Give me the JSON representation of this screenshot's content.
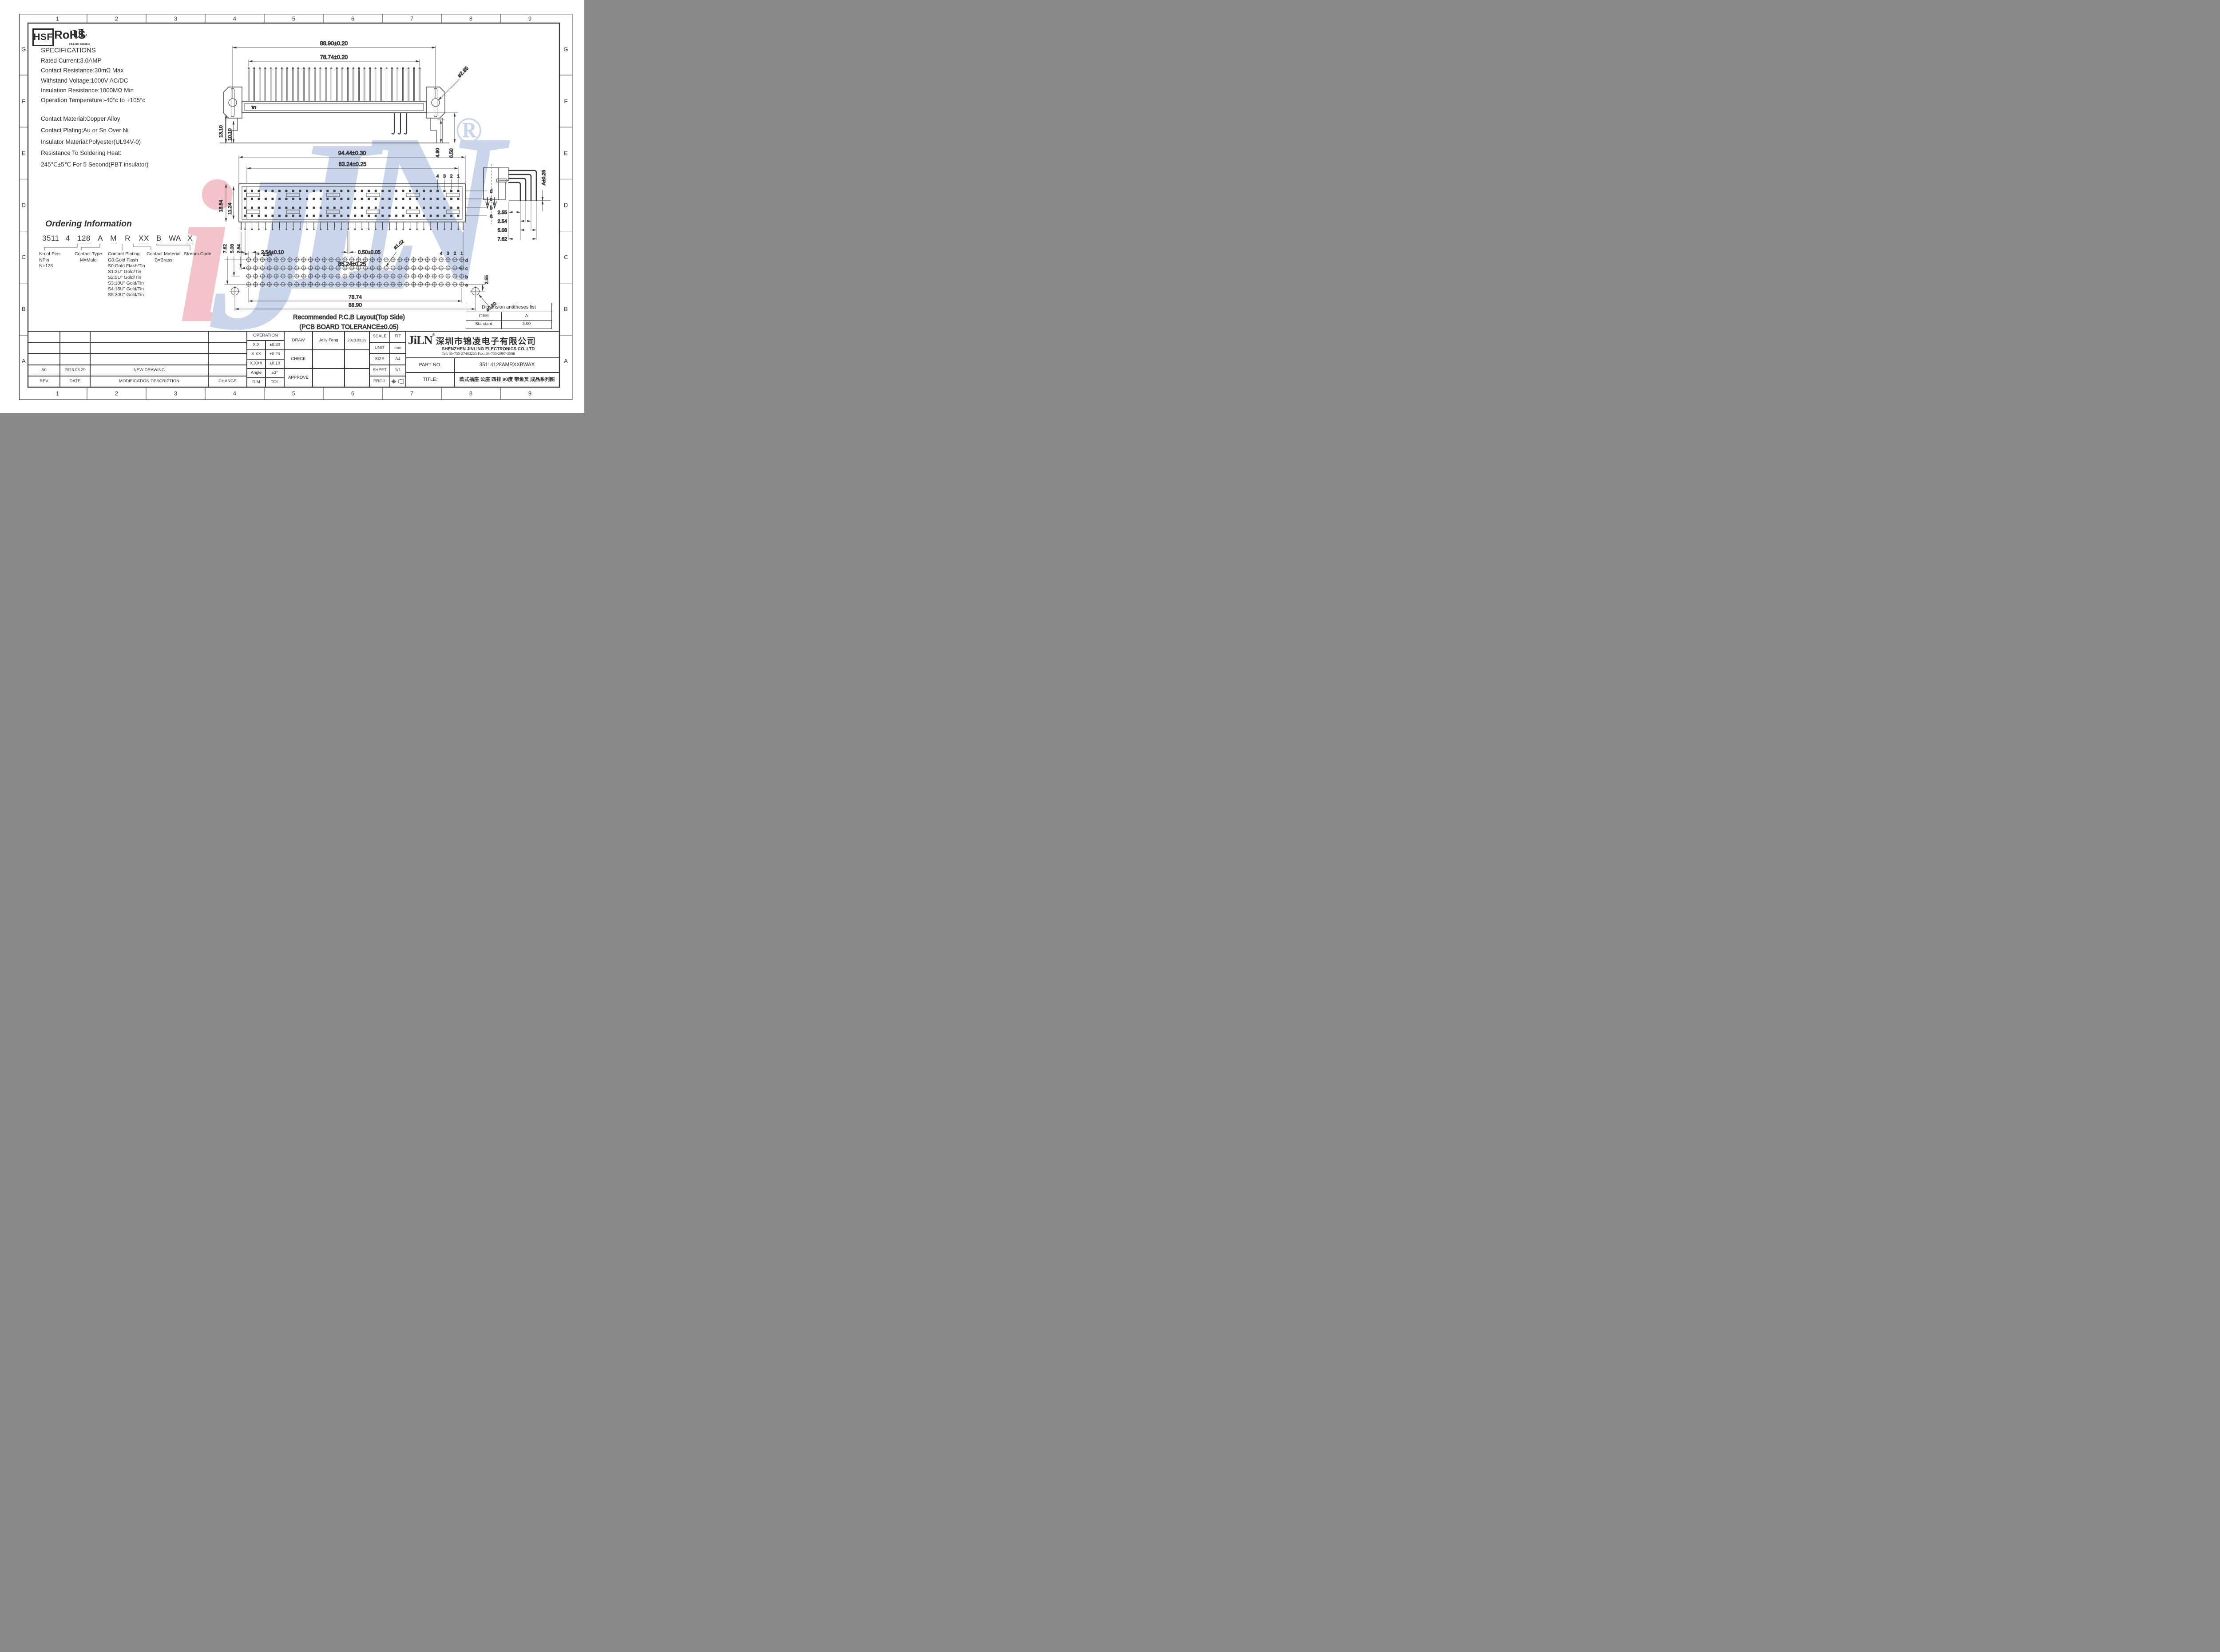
{
  "page": {
    "columns": [
      "1",
      "2",
      "3",
      "4",
      "5",
      "6",
      "7",
      "8",
      "9"
    ],
    "rows": [
      "G",
      "F",
      "E",
      "D",
      "C",
      "B",
      "A"
    ]
  },
  "certifications": {
    "hsf": "HSF",
    "rohs": "RoHS",
    "ul_mark": "UL",
    "ul_file": "FILE NO :E362810"
  },
  "specifications": {
    "title": "SPECIFICATIONS",
    "electrical": [
      "Rated Current:3.0AMP",
      "Contact Resistance:30mΩ Max",
      "Withstand Voltage:1000V AC/DC",
      "Insulation Resistance:1000MΩ Min",
      "Operation Temperature:-40°c to +105°c"
    ],
    "material": [
      "Contact Material:Copper Alloy",
      "Contact Plating:Au or Sn Over Ni",
      "Insulator Material:Polyester(UL94V-0)",
      "Resistance To Soldering Heat:",
      "245℃±5℃ For 5 Second(PBT insulator)"
    ]
  },
  "ordering": {
    "title": "Ordering Information",
    "tokens": [
      "3511",
      "4",
      "128",
      "A",
      "M",
      "R",
      "XX",
      "B",
      "WA",
      "X"
    ],
    "groups": [
      {
        "title": "No.of Pins",
        "lines": [
          "NPin",
          "N=128"
        ]
      },
      {
        "title": "Contact Type",
        "lines": [
          "M=Male"
        ]
      },
      {
        "title": "Contact Plating",
        "lines": [
          "G0:Gold Flash",
          "S0:Gold Flash/Tin",
          "S1:3U\" Gold/Tin",
          "S2:5U\" Gold/Tin",
          "S3:10U\" Gold/Tin",
          "S4:15U\" Gold/Tin",
          "S5:30U\" Gold/Tin"
        ]
      },
      {
        "title": "Contact Material",
        "lines": [
          "B=Brass"
        ]
      },
      {
        "title": "Stream Code",
        "lines": []
      }
    ]
  },
  "drawings": {
    "top_view": {
      "dim_width_outer": "88.90±0.20",
      "dim_width_inner": "78.74±0.20",
      "dim_left_outer": "13.10",
      "dim_left_inner": "10.10",
      "dim_hole": "ø2.85",
      "dim_right_inner": "4.90",
      "dim_right_outer": "6.50",
      "ul_mark": "UL"
    },
    "front_view": {
      "dim_width_outer": "94.44±0.30",
      "dim_width_inner": "83.24±0.25",
      "dim_left_outer": "13.54",
      "dim_left_inner": "11.24",
      "col_labels": [
        "4",
        "3",
        "2",
        "1"
      ],
      "row_labels": [
        "d",
        "c",
        "b",
        "a"
      ],
      "dim_pitch": "2.54±0.10",
      "dim_pin": "0.50±0.05",
      "dim_span": "85.24±0.25"
    },
    "side_view": {
      "dim_a": "A±0.25",
      "dims": [
        "2.55",
        "2.54",
        "5.08",
        "7.62"
      ]
    },
    "pcb_layout": {
      "dim_v1": "7.62",
      "dim_v2": "5.08",
      "dim_v3": "2.54",
      "dim_pitch": "2.54",
      "dim_hole_small": "ø1.02",
      "col_labels": [
        "4",
        "3",
        "2",
        "1"
      ],
      "row_labels": [
        "d",
        "c",
        "b",
        "a"
      ],
      "dim_offset": "2.55",
      "dim_span_inner": "78.74",
      "dim_span_outer": "88.90",
      "dim_hole_big": "ø2.80",
      "caption1": "Recommended P.C.B Layout(Top Side)",
      "caption2": "(PCB BOARD TOLERANCE±0.05)"
    }
  },
  "dimension_table": {
    "title": "Dimension antitheses list",
    "item_label": "ITEM",
    "item_value": "A",
    "standard_label": "Standard",
    "standard_value": "3.00"
  },
  "title_block": {
    "operation": {
      "title": "OPERATION",
      "rows": [
        [
          "X.X",
          "±0.30"
        ],
        [
          "X.XX",
          "±0.20"
        ],
        [
          "X.XXX",
          "±0.10"
        ],
        [
          "Angle",
          "±3°"
        ],
        [
          "DIM",
          "TOL"
        ]
      ]
    },
    "sign_rows": [
      {
        "label": "DRAW",
        "name": "Jelly Feng",
        "date": "2023.03.29"
      },
      {
        "label": "CHECK",
        "name": "",
        "date": ""
      },
      {
        "label": "APPROVE",
        "name": "",
        "date": ""
      }
    ],
    "info_rows": [
      [
        "SCALE",
        "FIT"
      ],
      [
        "UNIT",
        "mm"
      ],
      [
        "SIZE",
        "A4"
      ],
      [
        "SHEET",
        "1/1"
      ]
    ],
    "proj_label": "PROJ.",
    "company": {
      "logo": "JiLN",
      "reg": "®",
      "name_cn": "深圳市锦凌电子有限公司",
      "name_en": "SHENZHEN JINLING ELECTRONICS CO.,LTD",
      "contact": "Tel: 86-755-27483253  Fax: 86-755-2997-5588"
    },
    "part_no_label": "PART NO.",
    "part_no": "35114128AMRXXBWAX",
    "title_label": "TITLE:",
    "title_value": "欧式插座 公座 四排 90度 带鱼叉 成品系列图",
    "revision": {
      "entry": [
        "A0",
        "2023.03.29",
        "NEW DRAWING",
        ""
      ],
      "header": [
        "REV",
        "DATE",
        "MODIFICATION DESCRIPTION",
        "CHANGE"
      ]
    }
  },
  "watermark": {
    "l1": "J",
    "l2": "i",
    "l3": "L",
    "l4": "N",
    "reg": "®"
  }
}
